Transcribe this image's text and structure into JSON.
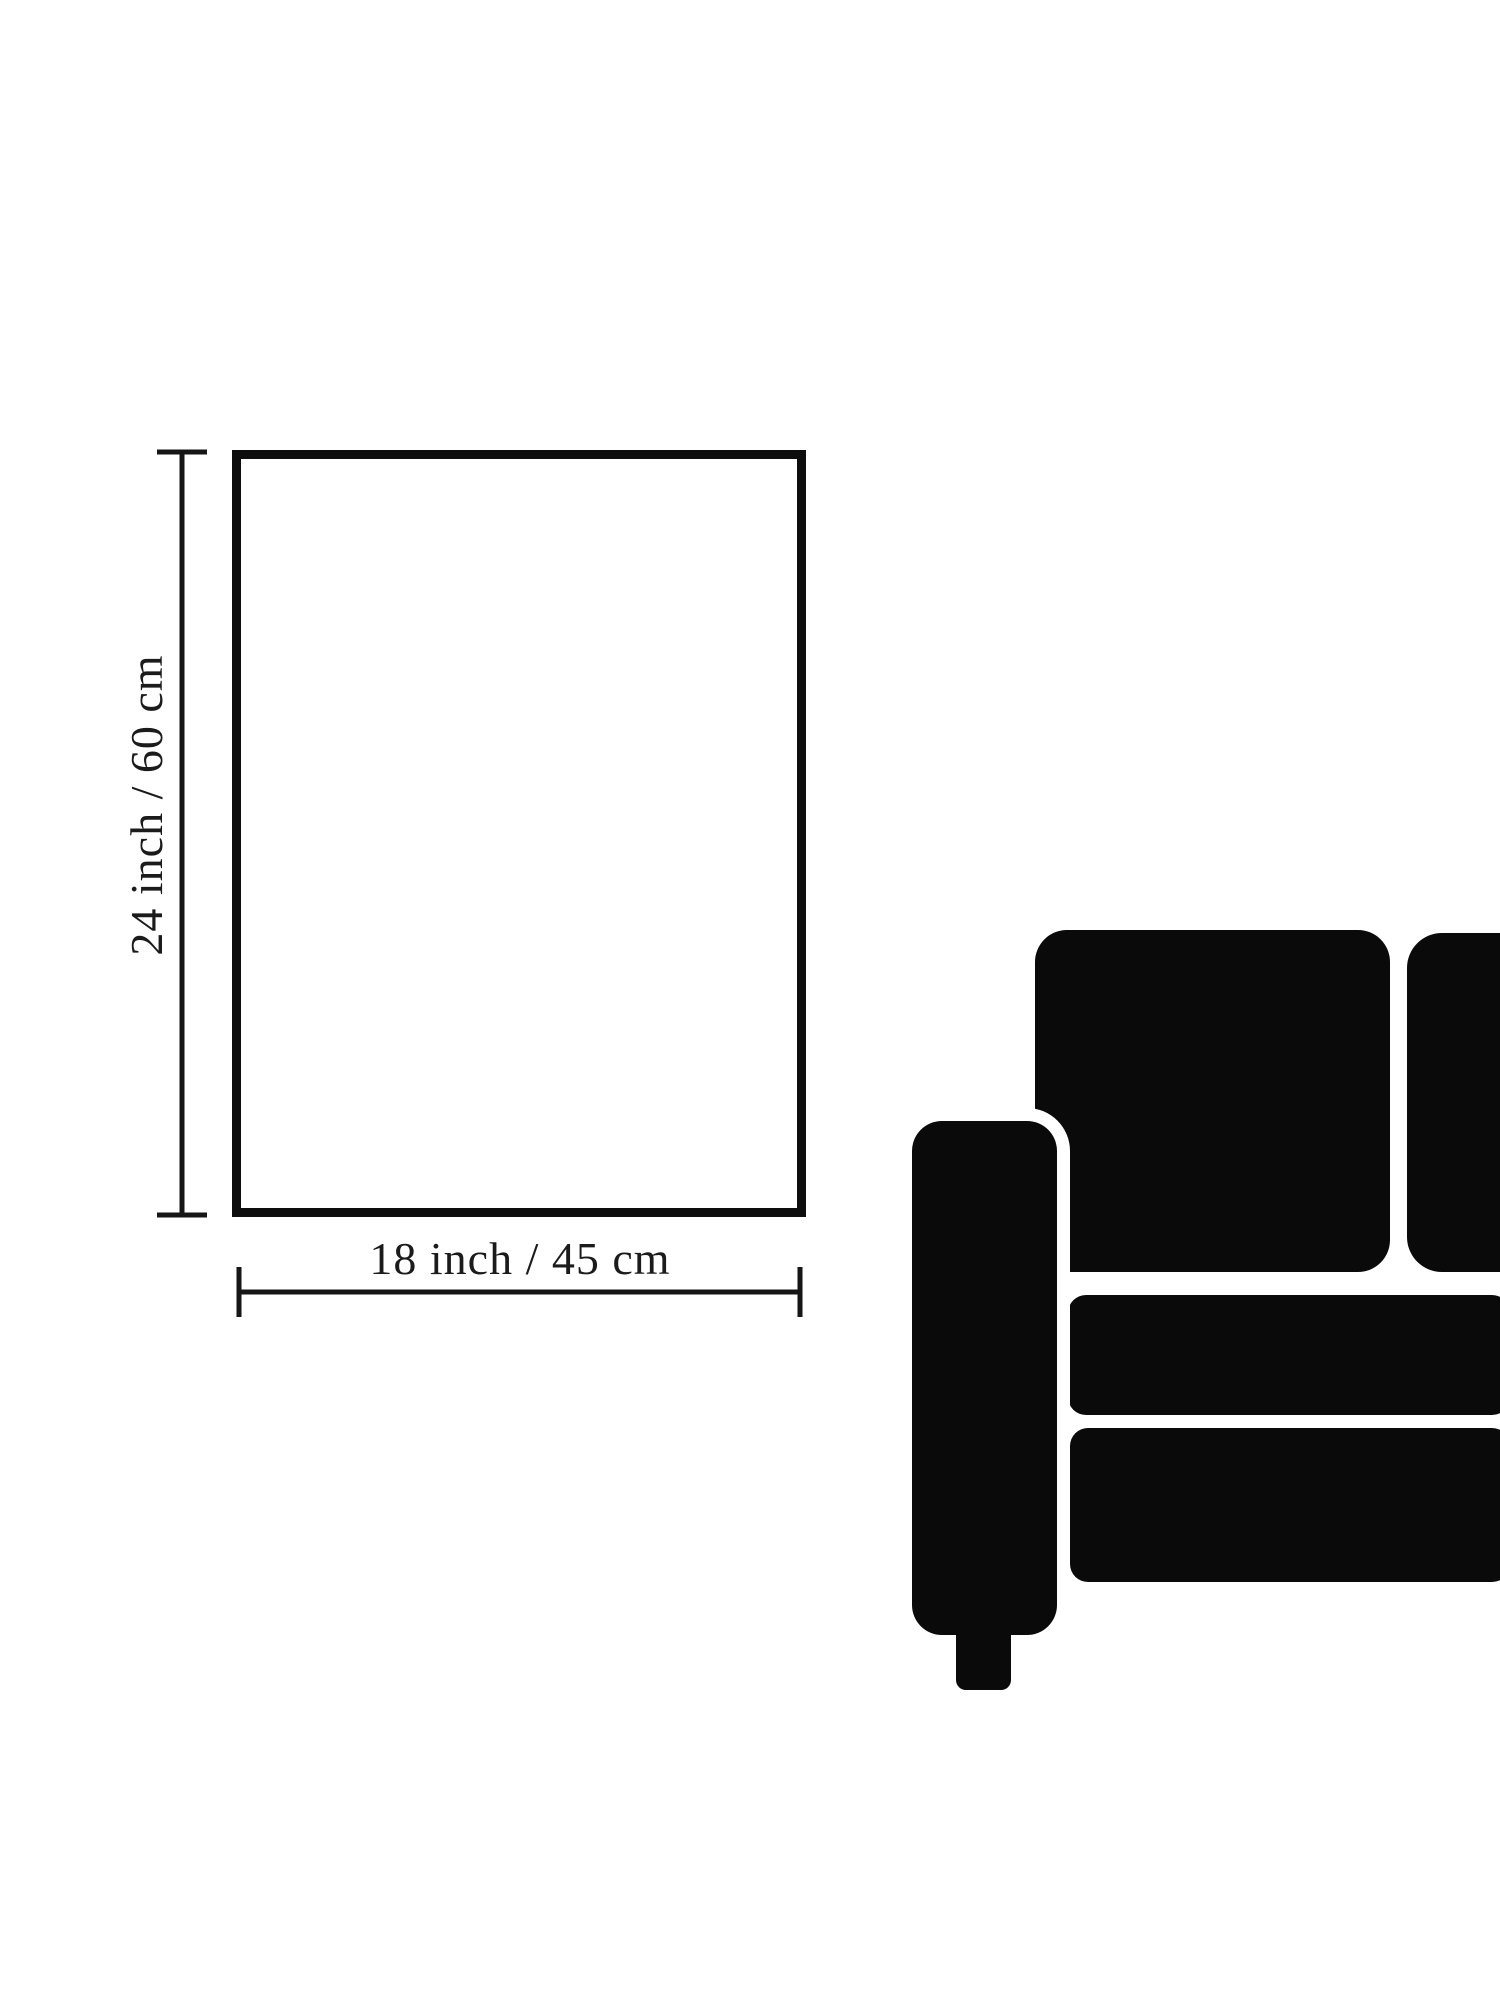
{
  "diagram": {
    "type": "product-size-diagram",
    "height_label": "24 inch / 60 cm",
    "width_label": "18 inch / 45 cm",
    "dimensions": {
      "width_inch": 18,
      "width_cm": 45,
      "height_inch": 24,
      "height_cm": 60
    },
    "icons": {
      "scale_reference": "sofa-silhouette"
    },
    "colors": {
      "background": "#ffffff",
      "ink": "#141414",
      "sofa": "#0a0a0a",
      "label_text": "#1b1b1b"
    }
  }
}
